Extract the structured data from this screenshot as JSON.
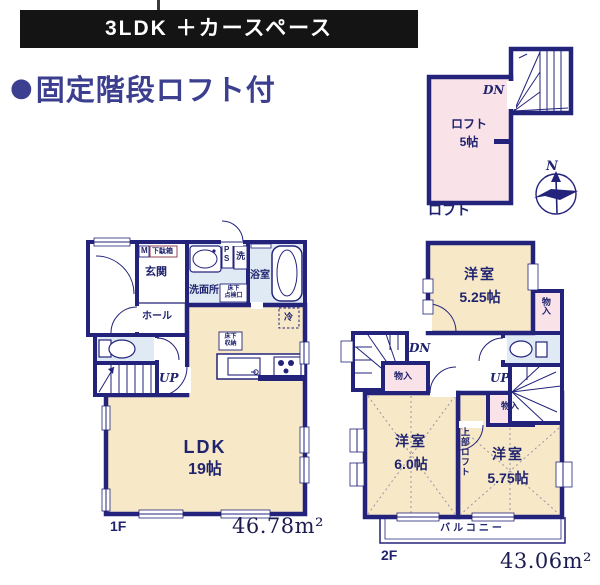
{
  "banner": {
    "title": "3LDK ＋カースペース"
  },
  "headline": {
    "bullet": "●",
    "text": "固定階段ロフト付"
  },
  "colors": {
    "wall": "#23237b",
    "room_cream": "#f7e8c7",
    "room_pink": "#f9e2e8",
    "room_blue": "#dfeaf4",
    "headline_text": "#3c3f90",
    "banner_bg": "#141414",
    "label_text": "#20246f"
  },
  "loft_plan": {
    "caption": "ロフト",
    "room": "ロフト",
    "size": "5帖",
    "down": "DN",
    "compass_north": "N"
  },
  "floor1": {
    "caption": "1F",
    "area": "46.78m²",
    "entrance": "玄関",
    "hall": "ホール",
    "meter": "M",
    "shoe_cabinet": "下駄箱",
    "washroom": "洗面所",
    "pipe_p": "P",
    "pipe_s": "S",
    "laundry": "洗",
    "hatch_line1": "床下",
    "hatch_line2": "点検口",
    "bath": "浴室",
    "fridge": "冷",
    "storage_line1": "床下",
    "storage_line2": "収納",
    "up": "UP",
    "ldk": "LDK",
    "ldk_size": "19帖"
  },
  "floor2": {
    "caption": "2F",
    "area": "43.06m²",
    "room_a": "洋室",
    "room_a_size": "5.25帖",
    "room_b": "洋室",
    "room_b_size": "6.0帖",
    "room_c": "洋室",
    "room_c_size": "5.75帖",
    "closet": "物入",
    "down": "DN",
    "up": "UP",
    "upper_loft": "上部ロフト",
    "balcony": "バルコニー"
  }
}
